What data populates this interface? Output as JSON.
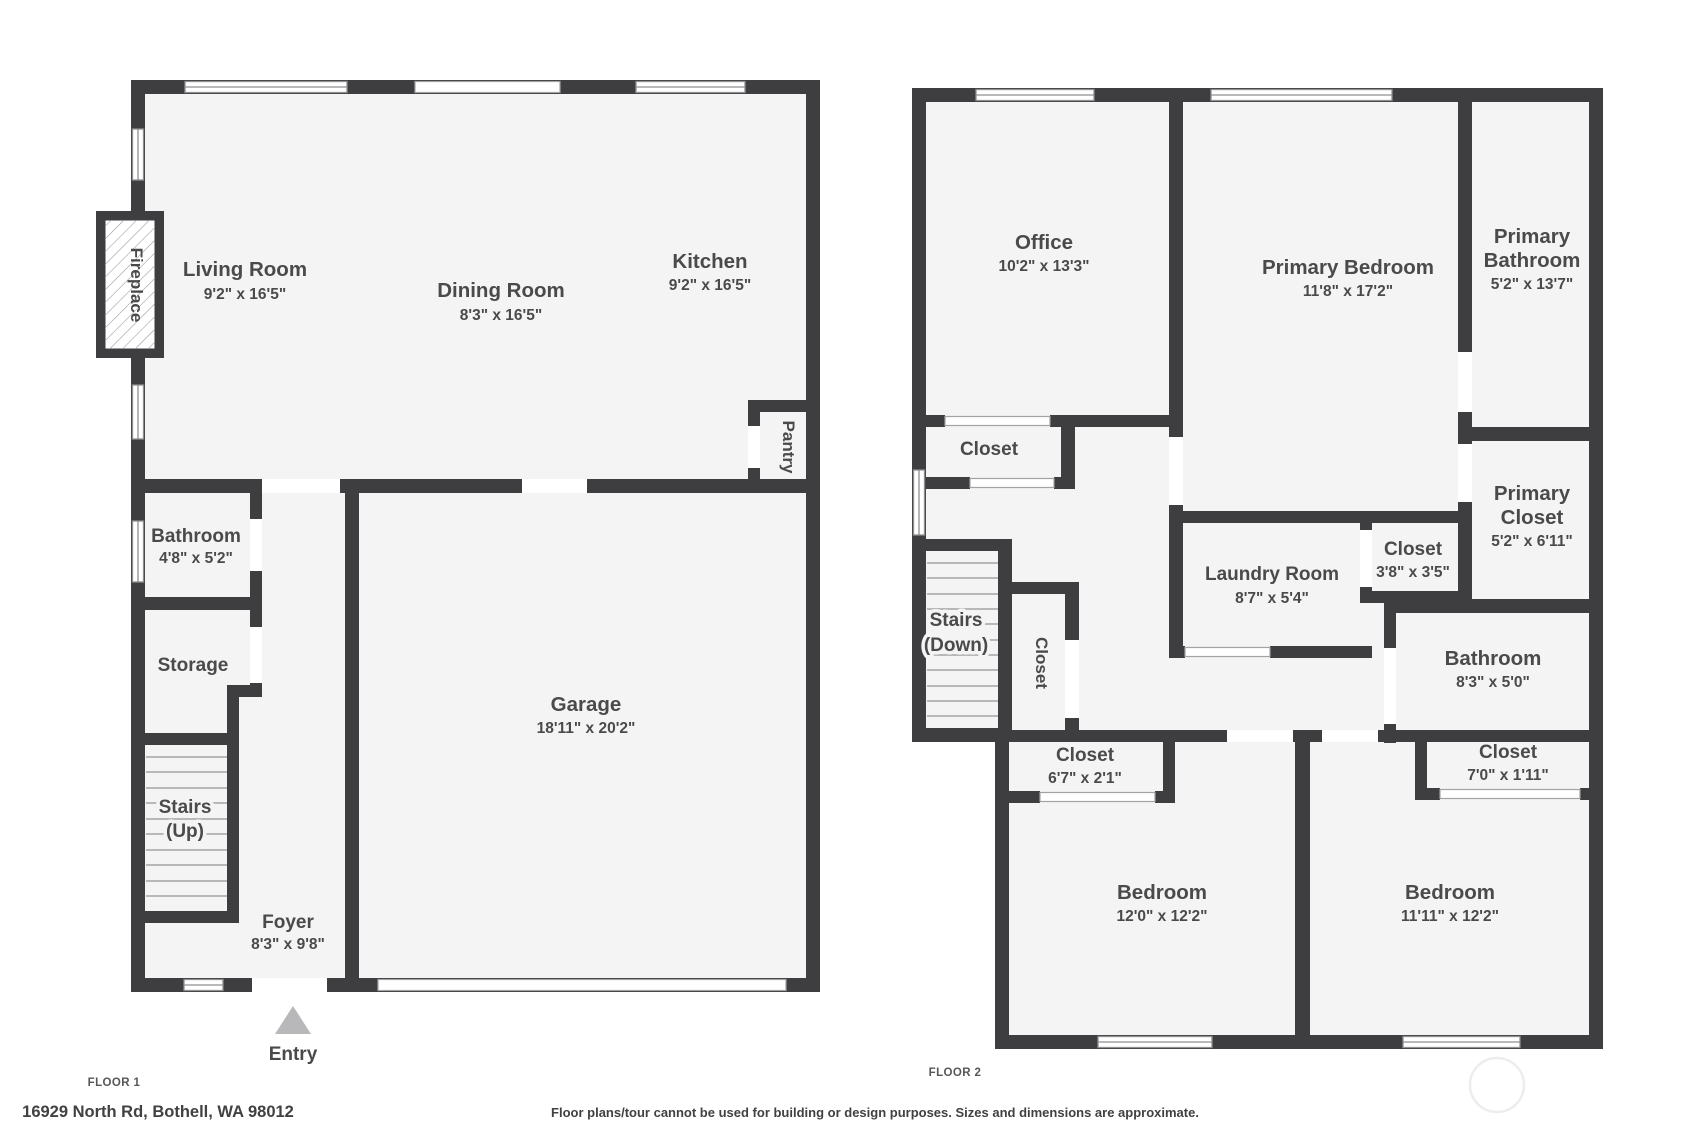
{
  "colors": {
    "wall": "#3e3e40",
    "floor_fill": "#f4f4f5",
    "label_text": "#4a4a4b",
    "window_frame": "#8f8f91",
    "stair_tread": "#b8b8ba",
    "entry_arrow": "#b8b8ba"
  },
  "floor1": {
    "title": "FLOOR 1",
    "address": "16929 North Rd, Bothell, WA 98012",
    "entry_label": "Entry",
    "rooms": {
      "living_room": {
        "name": "Living Room",
        "dims": "9'2\" x 16'5\""
      },
      "dining_room": {
        "name": "Dining Room",
        "dims": "8'3\" x 16'5\""
      },
      "kitchen": {
        "name": "Kitchen",
        "dims": "9'2\" x 16'5\""
      },
      "pantry": {
        "name": "Pantry"
      },
      "bathroom": {
        "name": "Bathroom",
        "dims": "4'8\" x 5'2\""
      },
      "storage": {
        "name": "Storage"
      },
      "stairs": {
        "name": "Stairs",
        "sub": "(Up)"
      },
      "foyer": {
        "name": "Foyer",
        "dims": "8'3\" x 9'8\""
      },
      "garage": {
        "name": "Garage",
        "dims": "18'11\" x 20'2\""
      },
      "fireplace": {
        "name": "Fireplace"
      }
    }
  },
  "floor2": {
    "title": "FLOOR 2",
    "rooms": {
      "office": {
        "name": "Office",
        "dims": "10'2\" x 13'3\""
      },
      "primary_bedroom": {
        "name": "Primary Bedroom",
        "dims": "11'8\" x 17'2\""
      },
      "primary_bathroom": {
        "line1": "Primary",
        "line2": "Bathroom",
        "dims": "5'2\" x 13'7\""
      },
      "office_closet": {
        "name": "Closet"
      },
      "stairs": {
        "name": "Stairs",
        "sub": "(Down)"
      },
      "hall_closet": {
        "name": "Closet"
      },
      "laundry_room": {
        "name": "Laundry Room",
        "dims": "8'7\" x 5'4\""
      },
      "small_closet": {
        "name": "Closet",
        "dims": "3'8\" x 3'5\""
      },
      "primary_closet": {
        "line1": "Primary",
        "line2": "Closet",
        "dims": "5'2\" x 6'11\""
      },
      "bathroom": {
        "name": "Bathroom",
        "dims": "8'3\" x 5'0\""
      },
      "left_bedroom_closet": {
        "name": "Closet",
        "dims": "6'7\" x 2'1\""
      },
      "right_bedroom_closet": {
        "name": "Closet",
        "dims": "7'0\" x 1'11\""
      },
      "left_bedroom": {
        "name": "Bedroom",
        "dims": "12'0\" x 12'2\""
      },
      "right_bedroom": {
        "name": "Bedroom",
        "dims": "11'11\" x 12'2\""
      }
    }
  },
  "footer": {
    "disclaimer": "Floor plans/tour cannot be used for building or design purposes. Sizes and dimensions are approximate."
  }
}
